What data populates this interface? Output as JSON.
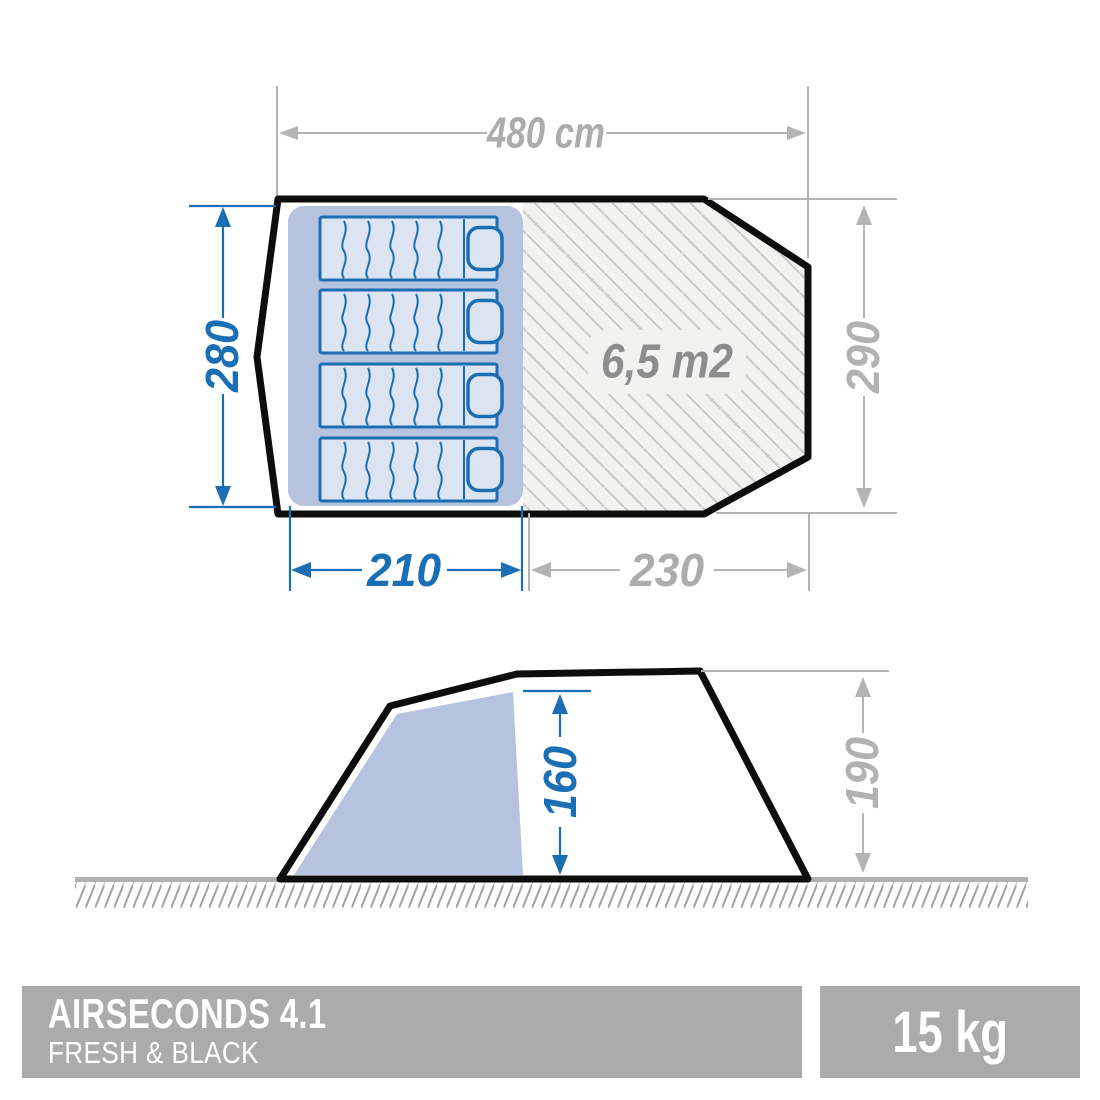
{
  "top_view": {
    "total_width": "480 cm",
    "bedroom_depth": "280",
    "bedroom_width": "210",
    "living_width": "230",
    "total_depth": "290",
    "living_area": "6,5 m2"
  },
  "side_view": {
    "interior_height": "160",
    "exterior_height": "190"
  },
  "footer": {
    "product_name": "AIRSECONDS 4.1",
    "product_line": "FRESH & BLACK",
    "weight": "15 kg"
  },
  "colors": {
    "dimension_blue": "#1a6eb4",
    "dimension_gray": "#b0b0b0",
    "area_text_gray": "#8d8d8d",
    "bedroom_fill": "#b5c3de",
    "mat_fill": "#dde4f1",
    "living_fill": "#f2f2f0",
    "banner_gray": "#ababab",
    "outline_black": "#0d0d0d"
  }
}
